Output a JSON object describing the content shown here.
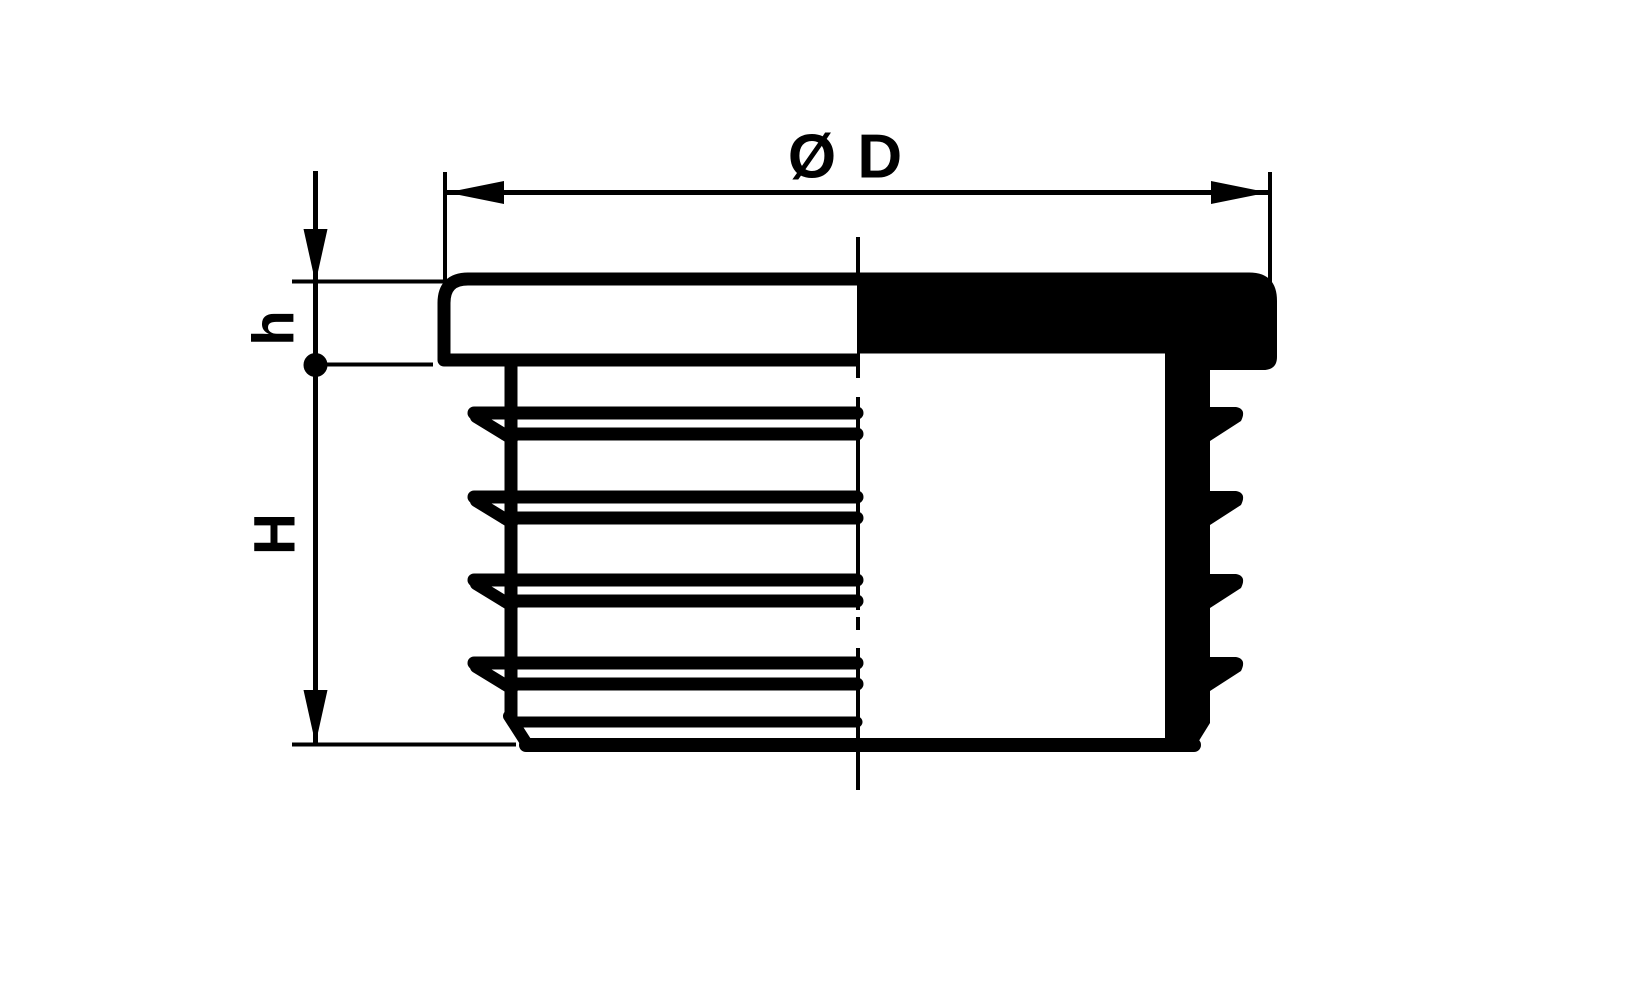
{
  "drawing": {
    "type": "technical-dimension-drawing",
    "subject": "round ribbed tube insert, half-section view",
    "background_color": "#ffffff",
    "line_color": "#000000",
    "labels": {
      "diameter": "Ø D",
      "head_height": "h",
      "body_height": "H"
    }
  }
}
